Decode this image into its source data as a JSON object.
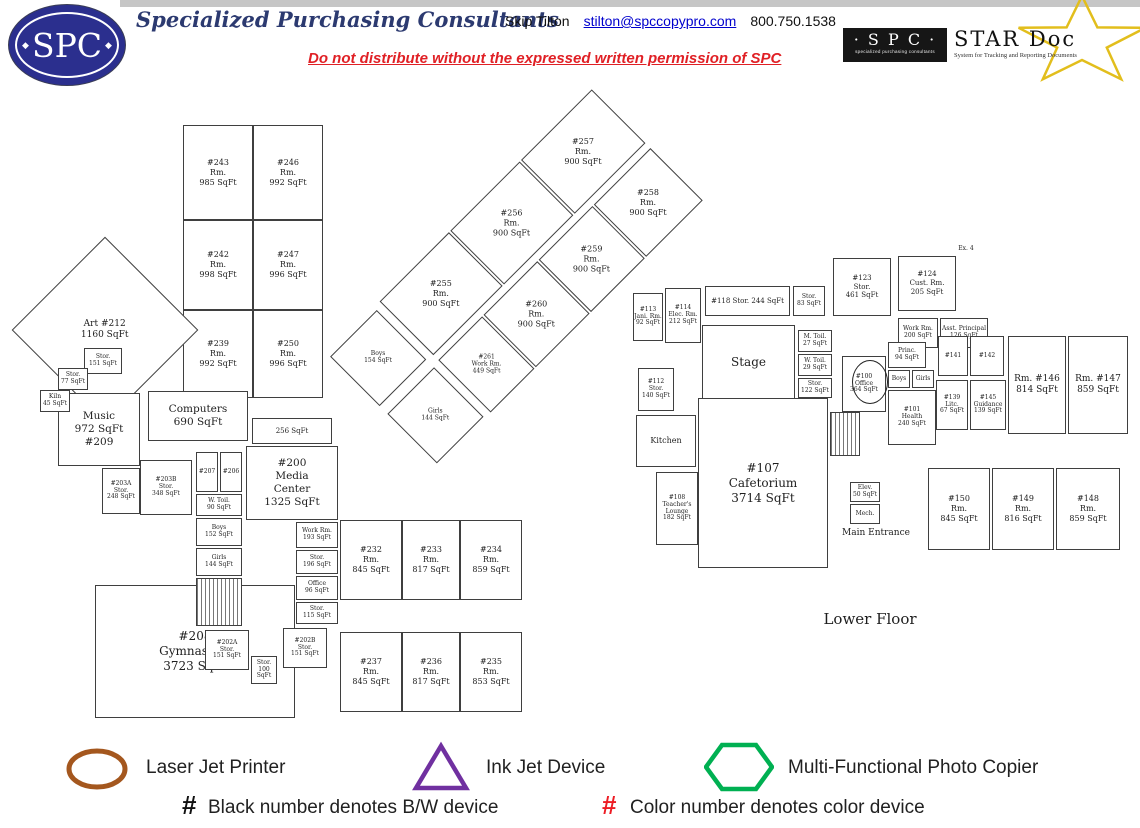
{
  "header": {
    "logo_text": "SPC",
    "logo_diamond": "◆",
    "company": "Specialized Purchasing Consultants",
    "contact_name": "Skip Tilton",
    "contact_email": "stilton@spccopypro.com",
    "contact_phone": "800.750.1538",
    "notice": "Do not distribute without the expressed written permission of SPC",
    "star_logo": {
      "spc": "· S P C ·",
      "spc_caption": "specialized purchasing consultants",
      "title": "STAR Doc",
      "caption": "System for Tracking and Reporting Documents",
      "star_color": "#E2BE1C"
    }
  },
  "plan": {
    "floor_label": "Lower Floor",
    "rooms": [
      {
        "id": "r243",
        "label": "#243\nRm.\n985 SqFt"
      },
      {
        "id": "r246",
        "label": "#246\nRm.\n992 SqFt"
      },
      {
        "id": "r242",
        "label": "#242\nRm.\n998 SqFt"
      },
      {
        "id": "r247",
        "label": "#247\nRm.\n996 SqFt"
      },
      {
        "id": "r239",
        "label": "#239\nRm.\n992 SqFt"
      },
      {
        "id": "r250",
        "label": "#250\nRm.\n996 SqFt"
      },
      {
        "id": "art",
        "label": "Art  #212\n1160 SqFt"
      },
      {
        "id": "stor151",
        "label": "Stor.\n151 SqFt"
      },
      {
        "id": "stor77",
        "label": "Stor.\n77 SqFt"
      },
      {
        "id": "kiln",
        "label": "Kiln\n45 SqFt"
      },
      {
        "id": "music",
        "label": "Music\n972 SqFt\n#209"
      },
      {
        "id": "computers",
        "label": "Computers\n690 SqFt"
      },
      {
        "id": "r203a",
        "label": "#203A\nStor.\n248 SqFt"
      },
      {
        "id": "r203b",
        "label": "#203B\nStor.\n348 SqFt"
      },
      {
        "id": "r207",
        "label": "#207"
      },
      {
        "id": "r206",
        "label": "#206"
      },
      {
        "id": "wtoil90",
        "label": "W. Toil.\n90 SqFt"
      },
      {
        "id": "boys152",
        "label": "Boys\n152 SqFt"
      },
      {
        "id": "girls144",
        "label": "Girls\n144 SqFt"
      },
      {
        "id": "r256sq",
        "label": "256 SqFt"
      },
      {
        "id": "media",
        "label": "#200\nMedia\nCenter\n1325 SqFt"
      },
      {
        "id": "work193",
        "label": "Work Rm.\n193 SqFt"
      },
      {
        "id": "stor196",
        "label": "Stor.\n196 SqFt"
      },
      {
        "id": "office96",
        "label": "Office\n96 SqFt"
      },
      {
        "id": "stor115",
        "label": "Stor.\n115 SqFt"
      },
      {
        "id": "gym",
        "label": "#208\nGymnasium\n3723 SqFt"
      },
      {
        "id": "r202a",
        "label": "#202A\nStor.\n151 SqFt"
      },
      {
        "id": "stor100",
        "label": "Stor.\n100 SqFt"
      },
      {
        "id": "r202b",
        "label": "#202B\nStor.\n151 SqFt"
      },
      {
        "id": "r232",
        "label": "#232\nRm.\n845 SqFt"
      },
      {
        "id": "r233",
        "label": "#233\nRm.\n817 SqFt"
      },
      {
        "id": "r234",
        "label": "#234\nRm.\n859 SqFt"
      },
      {
        "id": "r237",
        "label": "#237\nRm.\n845 SqFt"
      },
      {
        "id": "r236",
        "label": "#236\nRm.\n817 SqFt"
      },
      {
        "id": "r235",
        "label": "#235\nRm.\n853 SqFt"
      },
      {
        "id": "r113",
        "label": "#113\nJani. Rm.\n92 SqFt"
      },
      {
        "id": "r114",
        "label": "#114\nElec. Rm.\n212 SqFt"
      },
      {
        "id": "r118",
        "label": "#118   Stor. 244 SqFt"
      },
      {
        "id": "stor83",
        "label": "Stor.\n83 SqFt"
      },
      {
        "id": "r123",
        "label": "#123\nStor.\n461 SqFt"
      },
      {
        "id": "r124",
        "label": "#124\nCust. Rm.\n205 SqFt"
      },
      {
        "id": "ex4",
        "label": "Ex. 4"
      },
      {
        "id": "work200",
        "label": "Work Rm.\n200 SqFt"
      },
      {
        "id": "asstp",
        "label": "Asst. Principal\n126 SqFt"
      },
      {
        "id": "stage",
        "label": "Stage"
      },
      {
        "id": "r112",
        "label": "#112\nStor.\n140 SqFt"
      },
      {
        "id": "kitchen",
        "label": "Kitchen"
      },
      {
        "id": "mtoil",
        "label": "M. Toil.\n27 SqFt"
      },
      {
        "id": "wtoil29",
        "label": "W. Toil.\n29 SqFt"
      },
      {
        "id": "stor122",
        "label": "Stor.\n122 SqFt"
      },
      {
        "id": "r100",
        "label": "#100\nOffice\n364 SqFt"
      },
      {
        "id": "princ",
        "label": "Princ.\n94 SqFt"
      },
      {
        "id": "boysR",
        "label": "Boys"
      },
      {
        "id": "girlsR",
        "label": "Girls"
      },
      {
        "id": "r101",
        "label": "#101\nHealth\n240 SqFt"
      },
      {
        "id": "r141",
        "label": "#141"
      },
      {
        "id": "r142",
        "label": "#142"
      },
      {
        "id": "r139",
        "label": "#139\nLitc.\n67 SqFt"
      },
      {
        "id": "r145",
        "label": "#145\nGuidance\n139 SqFt"
      },
      {
        "id": "r146",
        "label": "Rm. #146\n814 SqFt"
      },
      {
        "id": "r147",
        "label": "Rm. #147\n859 SqFt"
      },
      {
        "id": "caf",
        "label": "#107\nCafetorium\n3714 SqFt"
      },
      {
        "id": "r108",
        "label": "#108\nTeacher's\nLounge\n182 SqFt"
      },
      {
        "id": "elev",
        "label": "Elev.\n50 SqFt"
      },
      {
        "id": "mech",
        "label": "Mech."
      },
      {
        "id": "r150",
        "label": "#150\nRm.\n845 SqFt"
      },
      {
        "id": "r149",
        "label": "#149\nRm.\n816 SqFt"
      },
      {
        "id": "r148",
        "label": "#148\nRm.\n859 SqFt"
      },
      {
        "id": "mainent",
        "label": "Main Entrance"
      },
      {
        "id": "lowerfloor",
        "label": "Lower Floor"
      }
    ],
    "diag_rooms": [
      {
        "id": "dboys",
        "label": "Boys\n154 SqFt"
      },
      {
        "id": "dgirls",
        "label": "Girls\n144 SqFt"
      },
      {
        "id": "r255",
        "label": "#255\nRm.\n900 SqFt"
      },
      {
        "id": "r256",
        "label": "#256\nRm.\n900 SqFt"
      },
      {
        "id": "r257",
        "label": "#257\nRm.\n900 SqFt"
      },
      {
        "id": "r261",
        "label": "#261\nWork Rm.\n449 SqFt"
      },
      {
        "id": "r260",
        "label": "#260\nRm.\n900 SqFt"
      },
      {
        "id": "r259",
        "label": "#259\nRm.\n900 SqFt"
      },
      {
        "id": "r258",
        "label": "#258\nRm.\n900 SqFt"
      }
    ]
  },
  "legend": {
    "items": [
      {
        "symbol": "ellipse",
        "label": "Laser Jet Printer",
        "color": "#A4571E"
      },
      {
        "symbol": "triangle",
        "label": "Ink Jet Device",
        "color": "#7030A0"
      },
      {
        "symbol": "hexagon",
        "label": "Multi-Functional Photo Copier",
        "color": "#00B052"
      }
    ],
    "notes": [
      {
        "mark": "#",
        "color": "#111111",
        "label": "Black number denotes B/W device"
      },
      {
        "mark": "#",
        "color": "#ED1C24",
        "label": "Color number denotes color device"
      }
    ]
  }
}
